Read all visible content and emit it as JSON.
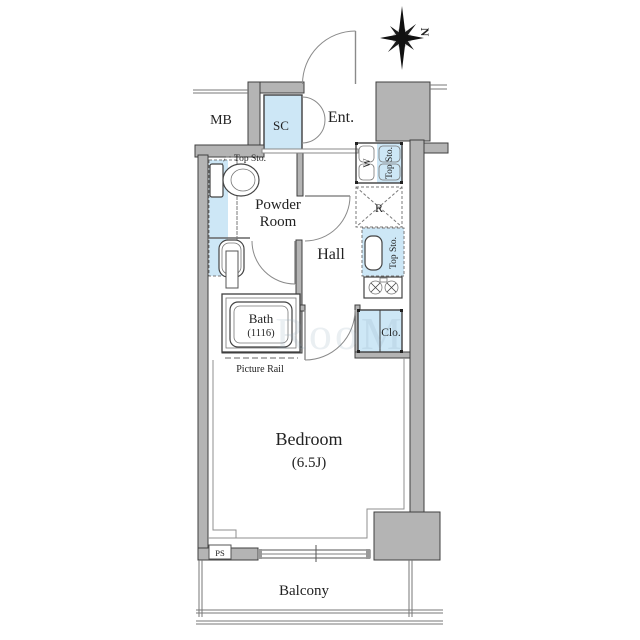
{
  "plan": {
    "compass": {
      "north_label": "N"
    },
    "watermark": "RooM",
    "rooms": {
      "mb": "MB",
      "shoe_closet": "SC",
      "entrance": "Ent.",
      "powder_room_line1": "Powder",
      "powder_room_line2": "Room",
      "hall": "Hall",
      "bath": "Bath",
      "bath_size": "(1116)",
      "bedroom": "Bedroom",
      "bedroom_size": "(6.5J)",
      "balcony": "Balcony",
      "closet": "Clo.",
      "pipe_space": "PS",
      "refrigerator_space": "R",
      "washer_space": "W"
    },
    "labels": {
      "top_storage_toilet": "Top Sto.",
      "top_storage_washer": "Top Sto.",
      "top_storage_kitchen": "Top Sto.",
      "picture_rail": "Picture Rail"
    },
    "colors": {
      "wall_fill": "#b4b4b4",
      "storage_blue": "#cde7f6",
      "outline": "#3f3f3f"
    }
  }
}
